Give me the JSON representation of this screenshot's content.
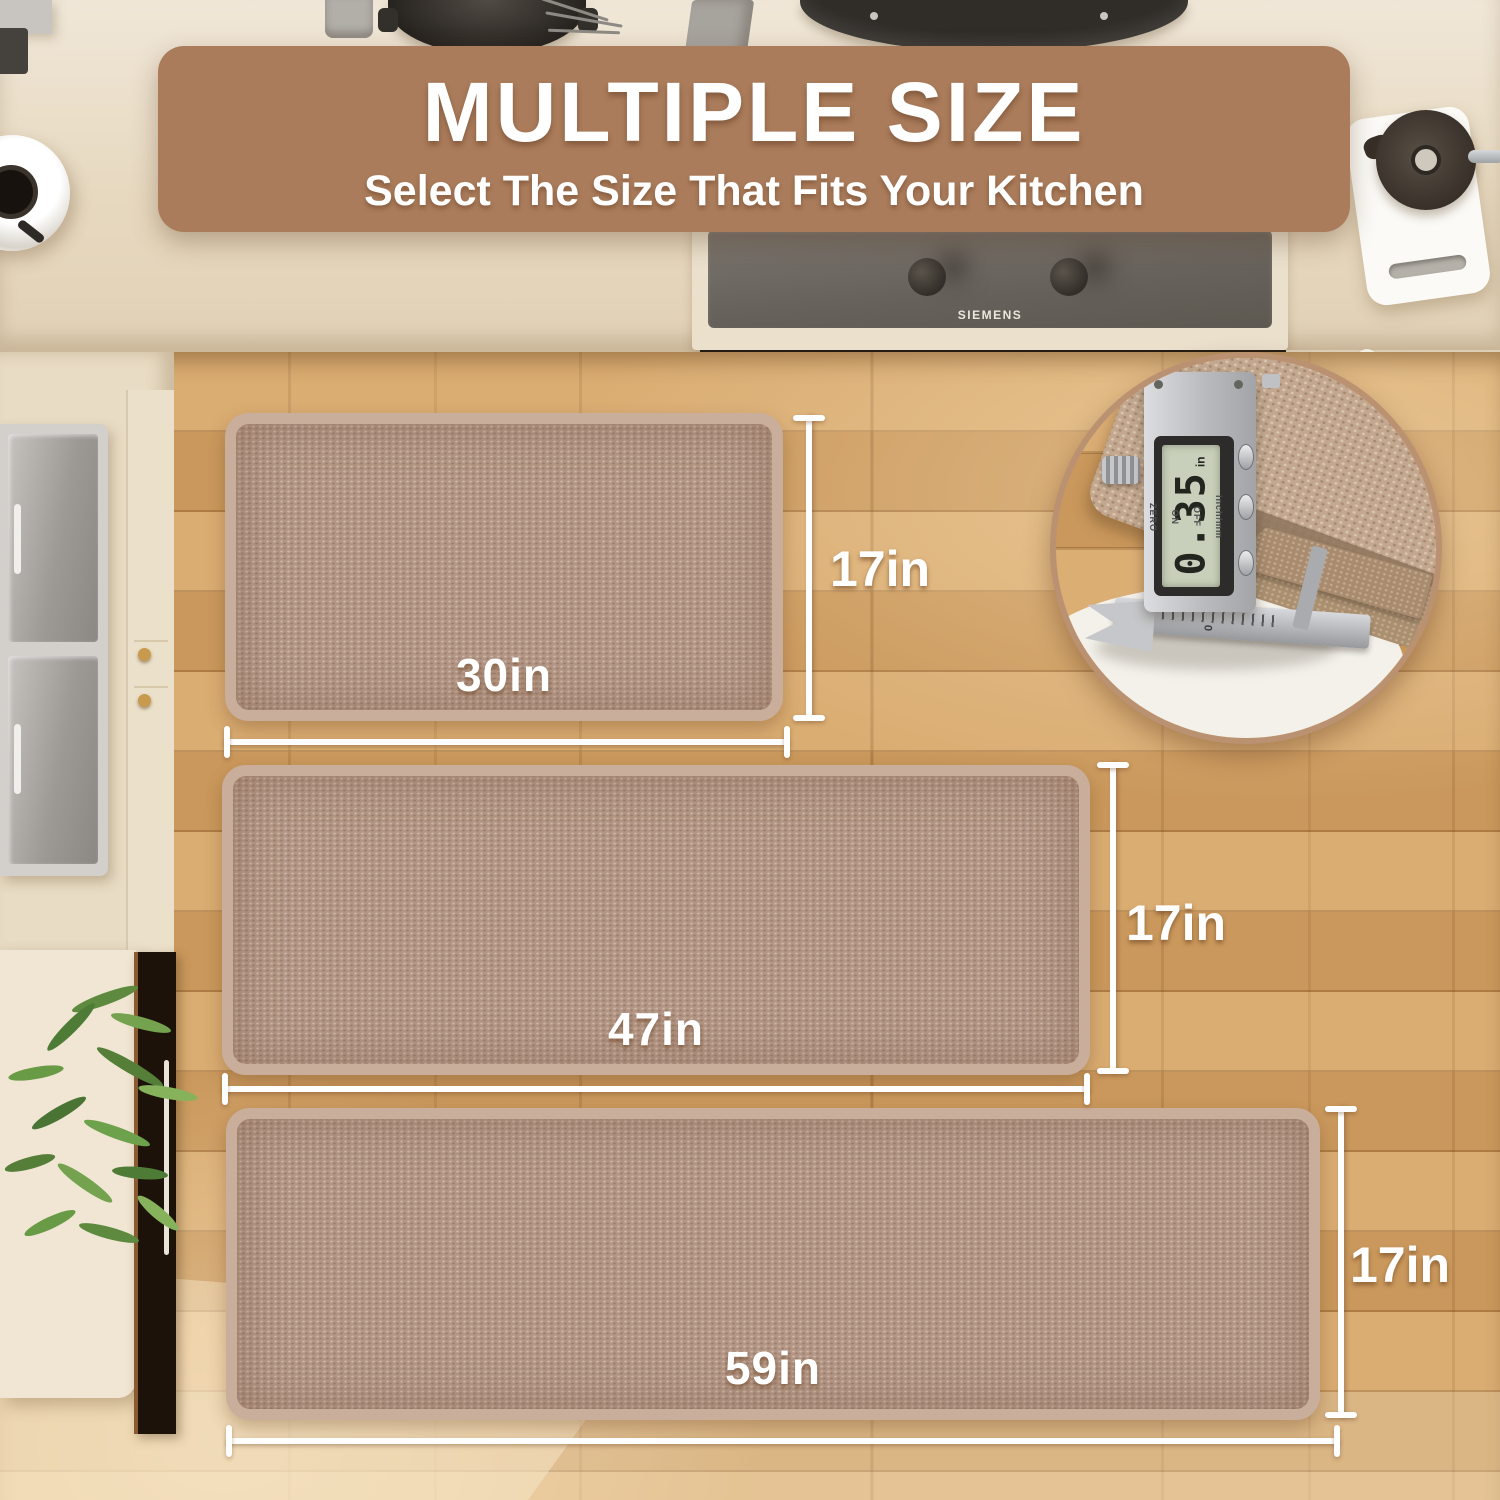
{
  "banner": {
    "title": "MULTIPLE SIZE",
    "subtitle": "Select The Size That Fits Your Kitchen",
    "bg_color": "#aa7c5b",
    "text_color": "#ffffff"
  },
  "stove": {
    "brand": "SIEMENS"
  },
  "mats": [
    {
      "name": "small-mat",
      "width_label": "30in",
      "height_label": "17in"
    },
    {
      "name": "medium-mat",
      "width_label": "47in",
      "height_label": "17in"
    },
    {
      "name": "large-mat",
      "width_label": "59in",
      "height_label": "17in"
    }
  ],
  "inset": {
    "display_value": "0.35",
    "display_unit": "in",
    "labels": {
      "zero": "ZERO",
      "on": "ON",
      "off": "OFF"
    },
    "mode_label": "inch/mm",
    "scale_zero": "0"
  },
  "colors": {
    "banner_brown": "#aa7c5b",
    "mat_fill": "#b39685",
    "mat_binding": "#c9ae9b",
    "floor_oak": "#d2a164",
    "counter_cream": "#ece1cd",
    "dimension_white": "#ffffff"
  }
}
